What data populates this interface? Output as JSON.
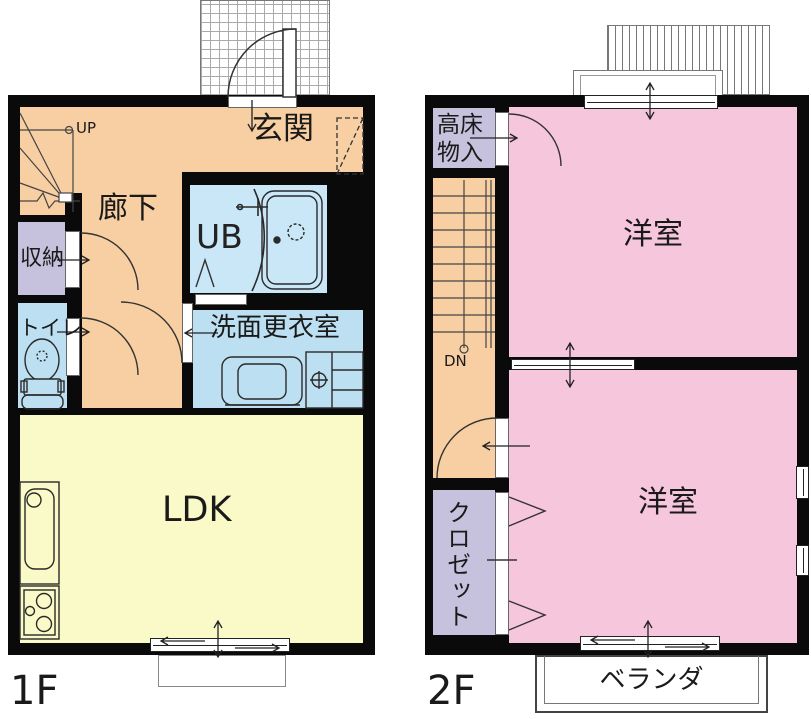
{
  "colors": {
    "wall": "#0a0a0a",
    "corridor": "#F7CFA2",
    "room_pink": "#F6C6DC",
    "ldk_yellow": "#FAFAC8",
    "water_blue": "#BCE0F2",
    "ub_blue": "#C9E7F7",
    "storage_lavender": "#C6C1DC"
  },
  "floor1": {
    "floor_label": "1F",
    "genkan": "玄関",
    "rouka": "廊下",
    "shuno": "収納",
    "toilet": "トイレ",
    "ub": "UB",
    "senmen": "洗面更衣室",
    "ldk": "LDK",
    "stairs_up": "UP"
  },
  "floor2": {
    "floor_label": "2F",
    "takayuka_line1": "高床",
    "takayuka_line2": "物入",
    "stairs_down": "DN",
    "yoshitsu_upper": "洋室",
    "yoshitsu_lower": "洋室",
    "closet": "クロゼット",
    "veranda": "ベランダ"
  },
  "icons": {
    "fixtures": [
      "winder-stairs",
      "straight-stairs",
      "entrance-swing-door",
      "interior-swing-doors",
      "folding-closet-doors",
      "sliding-windows",
      "toilet",
      "bathtub",
      "shower-door",
      "washing-machine",
      "vanity-sink",
      "kitchen-sink",
      "gas-stove",
      "shoe-cabinet-dashed",
      "porch-hatch",
      "roof-eave-hatch"
    ]
  }
}
